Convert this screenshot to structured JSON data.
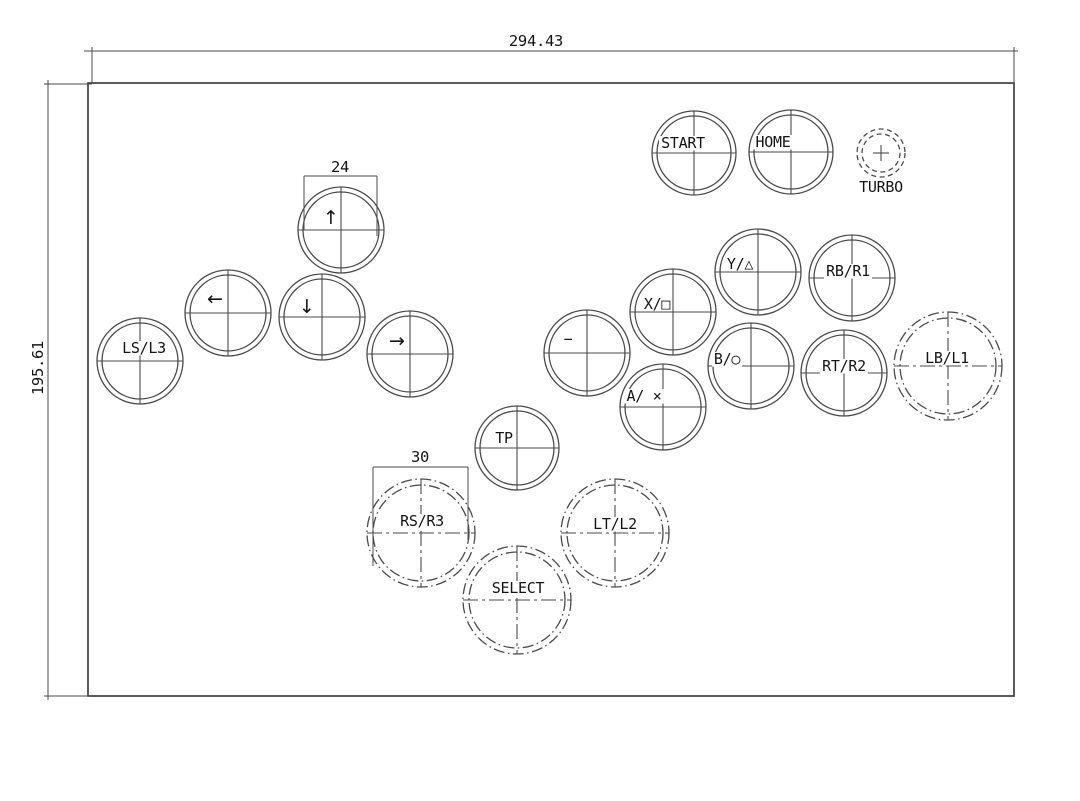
{
  "meta": {
    "background_color": "#ffffff",
    "line_color": "#4a4a4a",
    "text_color": "#141414",
    "drawing_type": "arcade-controller-panel-cad-drawing"
  },
  "dimensions": {
    "panel_width": {
      "text": "294.43"
    },
    "panel_height": {
      "text": "195.61"
    },
    "small_button": {
      "text": "24"
    },
    "large_button": {
      "text": "30"
    }
  },
  "buttons": [
    {
      "id": "start",
      "label": "START",
      "cx": 694,
      "cy": 153,
      "ro": 42,
      "ri": 37,
      "style": "solid",
      "dx": -11,
      "dy": -5
    },
    {
      "id": "home",
      "label": "HOME",
      "cx": 791,
      "cy": 152,
      "ro": 42,
      "ri": 37,
      "style": "solid",
      "dx": -18,
      "dy": -5
    },
    {
      "id": "up",
      "label": "↑",
      "cx": 341,
      "cy": 230,
      "ro": 43,
      "ri": 38,
      "style": "solid",
      "dx": -10,
      "dy": -6,
      "arrow": true
    },
    {
      "id": "left",
      "label": "←",
      "cx": 228,
      "cy": 313,
      "ro": 43,
      "ri": 38,
      "style": "solid",
      "dx": -13,
      "dy": -8,
      "arrow": true
    },
    {
      "id": "down",
      "label": "↓",
      "cx": 322,
      "cy": 317,
      "ro": 43,
      "ri": 38,
      "style": "solid",
      "dx": -15,
      "dy": -4,
      "arrow": true
    },
    {
      "id": "right",
      "label": "→",
      "cx": 410,
      "cy": 354,
      "ro": 43,
      "ri": 38,
      "style": "solid",
      "dx": -13,
      "dy": -7,
      "arrow": true
    },
    {
      "id": "ls-l3",
      "label": "LS/L3",
      "cx": 140,
      "cy": 361,
      "ro": 43,
      "ri": 38,
      "style": "solid",
      "dx": 4,
      "dy": -8
    },
    {
      "id": "minus",
      "label": "−",
      "cx": 587,
      "cy": 353,
      "ro": 43,
      "ri": 38,
      "style": "solid",
      "dx": -19,
      "dy": -9
    },
    {
      "id": "x-square",
      "label": "X/□",
      "cx": 673,
      "cy": 312,
      "ro": 43,
      "ri": 38,
      "style": "solid",
      "dx": -16,
      "dy": -3
    },
    {
      "id": "y-triangle",
      "label": "Y/△",
      "cx": 758,
      "cy": 272,
      "ro": 43,
      "ri": 38,
      "style": "solid",
      "dx": -18,
      "dy": -3
    },
    {
      "id": "rb-r1",
      "label": "RB/R1",
      "cx": 852,
      "cy": 278,
      "ro": 43,
      "ri": 38,
      "style": "solid",
      "dx": -4,
      "dy": -2
    },
    {
      "id": "b-circle",
      "label": "B/○",
      "cx": 751,
      "cy": 366,
      "ro": 43,
      "ri": 38,
      "style": "solid",
      "dx": -24,
      "dy": -2
    },
    {
      "id": "rt-r2",
      "label": "RT/R2",
      "cx": 844,
      "cy": 373,
      "ro": 43,
      "ri": 38,
      "style": "solid",
      "dx": 0,
      "dy": -2
    },
    {
      "id": "a-cross",
      "label": "A/ ×",
      "cx": 663,
      "cy": 407,
      "ro": 43,
      "ri": 38,
      "style": "solid",
      "dx": -19,
      "dy": -6
    },
    {
      "id": "tp",
      "label": "TP",
      "cx": 517,
      "cy": 448,
      "ro": 42,
      "ri": 37,
      "style": "solid",
      "dx": -13,
      "dy": -5
    },
    {
      "id": "lb-l1",
      "label": "LB/L1",
      "cx": 948,
      "cy": 366,
      "ro": 54,
      "ri": 48,
      "style": "dashdot",
      "dx": -1,
      "dy": -3
    },
    {
      "id": "rs-r3",
      "label": "RS/R3",
      "cx": 421,
      "cy": 533,
      "ro": 54,
      "ri": 48,
      "style": "dashdot",
      "dx": 1,
      "dy": -7
    },
    {
      "id": "lt-l2",
      "label": "LT/L2",
      "cx": 615,
      "cy": 533,
      "ro": 54,
      "ri": 48,
      "style": "dashdot",
      "dx": 0,
      "dy": -4
    },
    {
      "id": "select",
      "label": "SELECT",
      "cx": 517,
      "cy": 600,
      "ro": 54,
      "ri": 48,
      "style": "dashdot",
      "dx": 1,
      "dy": -7
    },
    {
      "id": "turbo",
      "label": "TURBO",
      "cx": 881,
      "cy": 153,
      "ro": 24,
      "ri": 19,
      "style": "dashed",
      "dx": 0,
      "dy": 39,
      "cross": "plus",
      "label_below": true
    }
  ]
}
